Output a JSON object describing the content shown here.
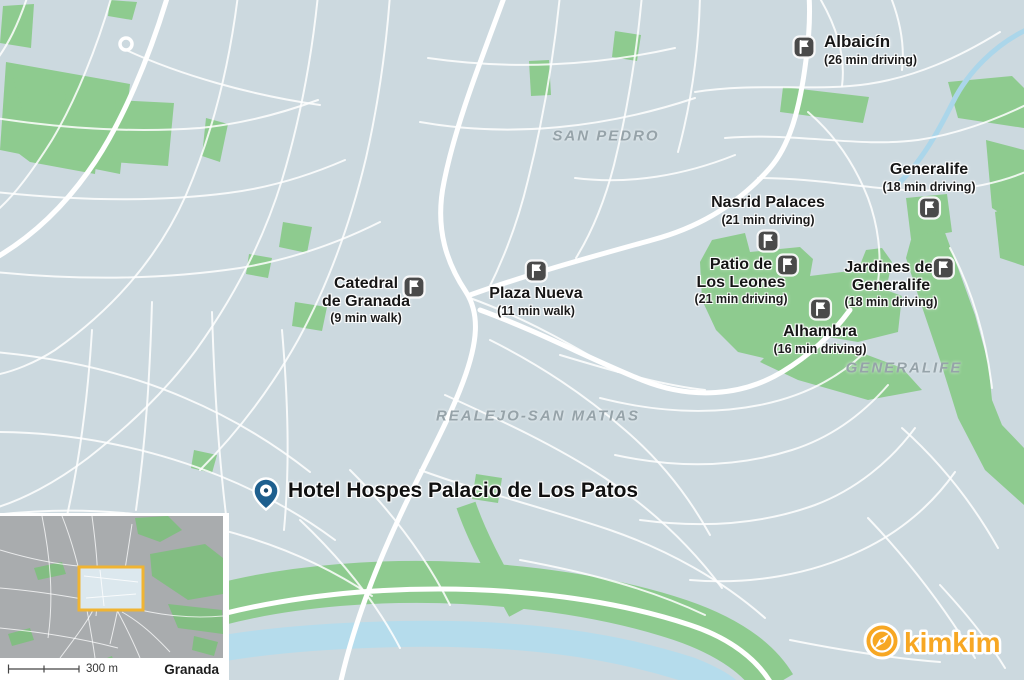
{
  "map": {
    "hotel": {
      "name": "Hotel Hospes Palacio de Los Patos"
    },
    "markers": [
      {
        "name": "Albaicín",
        "time": "(26 min driving)"
      },
      {
        "name": "Generalife",
        "time": "(18 min driving)"
      },
      {
        "name": "Nasrid Palaces",
        "time": "(21 min driving)"
      },
      {
        "line1": "Patio de",
        "line2": "Los Leones",
        "time": "(21 min driving)"
      },
      {
        "line1": "Jardines del",
        "line2": "Generalife",
        "time": "(18 min driving)"
      },
      {
        "name": "Alhambra",
        "time": "(16 min driving)"
      },
      {
        "name": "Plaza Nueva",
        "time": "(11 min walk)"
      },
      {
        "line1": "Catedral",
        "line2": "de Granada",
        "time": "(9 min walk)"
      }
    ],
    "areas": [
      {
        "name": "SAN PEDRO"
      },
      {
        "name": "REALEJO-SAN MATIAS"
      },
      {
        "name": "GENERALIFE"
      }
    ],
    "colors": {
      "land": "#ccd9df",
      "park": "#8ecb8f",
      "water": "#b5dcec",
      "road": "#ffffff",
      "marker_background": "#4a4a4a",
      "pin_blue": "#1e5f8e",
      "area_label_gray": "#96a3a9",
      "viewport_box_yellow": "#f0b433",
      "inset_land": "#a9acae",
      "inset_park": "#82bd82",
      "brand_orange": "#f7a723",
      "label_text": "#161616"
    }
  },
  "inset": {
    "scale_label": "300 m",
    "city": "Granada"
  },
  "logo": {
    "brand": "kimkim"
  }
}
